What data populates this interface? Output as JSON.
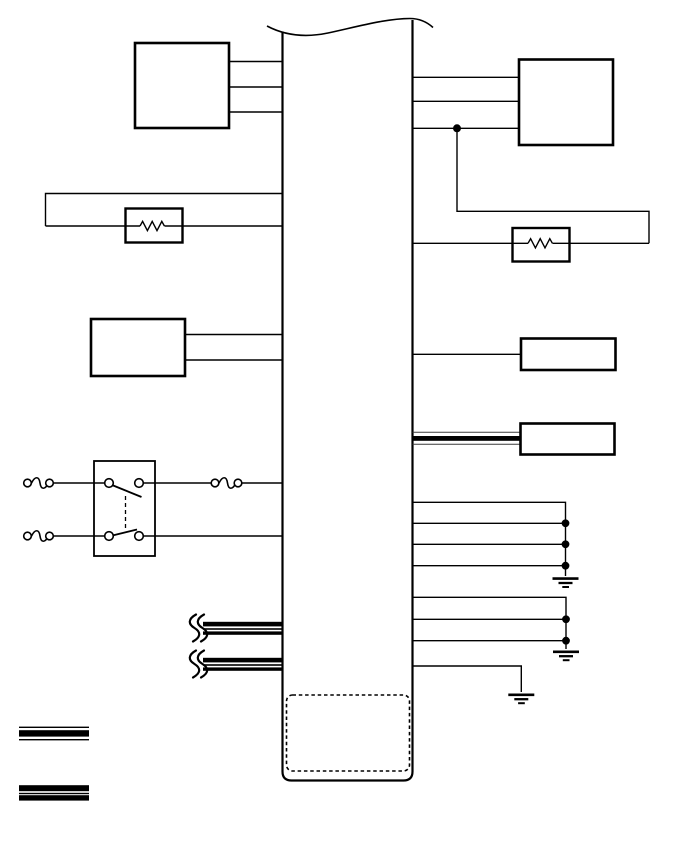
{
  "page": {
    "background": "#ffffff",
    "ink": "#000000",
    "kind": "automotive-wiring-schematic",
    "description": "Central control-module strip (torn top edge, rounded bottom, dashed sub-connector) with component boxes, two resistor loops, a dual-contact switch with inline connectors, shielded bus cables, junction dots and three chassis-ground points. No visible text labels."
  },
  "module": {
    "name": "central-control-module",
    "top_edge": "torn-wavy",
    "bottom_connector": "dashed-rounded-outline"
  },
  "components": {
    "left_side": [
      {
        "name": "top-left-component-box",
        "wires": 3
      },
      {
        "name": "left-resistor-loop",
        "resistors": 1
      },
      {
        "name": "mid-left-component-box",
        "wires": 2
      },
      {
        "name": "dual-contact-switch",
        "contacts": 2,
        "inline_connectors": 3,
        "linked": "dashed-mechanical-link"
      },
      {
        "name": "shielded-bus-upper",
        "style": "thick-thin-thick",
        "break_symbol": true
      },
      {
        "name": "shielded-bus-lower",
        "style": "thick-thin-thick",
        "break_symbol": true
      }
    ],
    "right_side": [
      {
        "name": "top-right-component-box",
        "wires": 3,
        "junction_dots": 1
      },
      {
        "name": "right-resistor-loop",
        "resistors": 1
      },
      {
        "name": "mid-right-component-box",
        "wires": 1
      },
      {
        "name": "shielded-component-box",
        "cable_style": "thin-thick-thin"
      },
      {
        "name": "ground-group-a",
        "wires": 4,
        "junction_dots": 3,
        "ground": true
      },
      {
        "name": "ground-group-b",
        "wires": 3,
        "junction_dots": 2,
        "ground": true
      },
      {
        "name": "single-ground-wire",
        "wires": 1,
        "ground": true
      }
    ]
  },
  "counts": {
    "resistors": 2,
    "ground_symbols": 3,
    "junction_dots": 6,
    "component_boxes": 5,
    "inline_connector_breaks": 3
  },
  "legend": {
    "items": [
      {
        "name": "cable-sample-a",
        "pattern": "thin-thick-thin"
      },
      {
        "name": "cable-sample-b",
        "pattern": "thick-thin-thick"
      }
    ]
  }
}
